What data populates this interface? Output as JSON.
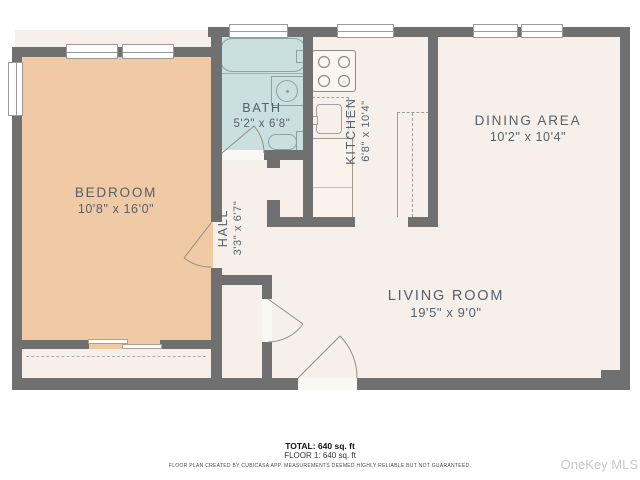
{
  "title": "Apartment floor plan",
  "rooms": {
    "bedroom": {
      "name": "BEDROOM",
      "dims": "10'8\" x 16'0\""
    },
    "bath": {
      "name": "BATH",
      "dims": "5'2\" x 6'8\""
    },
    "hall": {
      "name": "HALL",
      "dims": "3'3\" x 6'7\""
    },
    "kitchen": {
      "name": "KITCHEN",
      "dims": "6'8\" x 10'4\""
    },
    "dining": {
      "name": "DINING AREA",
      "dims": "10'2\" x 10'4\""
    },
    "living": {
      "name": "LIVING ROOM",
      "dims": "19'5\" x 9'0\""
    }
  },
  "footer": {
    "total": "TOTAL: 640 sq. ft",
    "floor1": "FLOOR 1: 640 sq. ft",
    "disclaimer": "FLOOR PLAN CREATED BY CUBICASA APP. MEASUREMENTS DEEMED HIGHLY RELIABLE BUT NOT GUARANTEED.",
    "watermark": "OneKey MLS"
  },
  "icons": [
    "bathtub-icon",
    "bathroom-sink-icon",
    "toilet-icon",
    "stove-icon",
    "kitchen-sink-icon",
    "window",
    "door-swing-icon"
  ],
  "colors": {
    "wall": "#707070",
    "bedroom_fill": "#f0c9a5",
    "bath_fill": "#c9e0df",
    "floor_fill": "#f7f0ea",
    "label_text": "#566069",
    "watermark": "#c9c9c9"
  }
}
